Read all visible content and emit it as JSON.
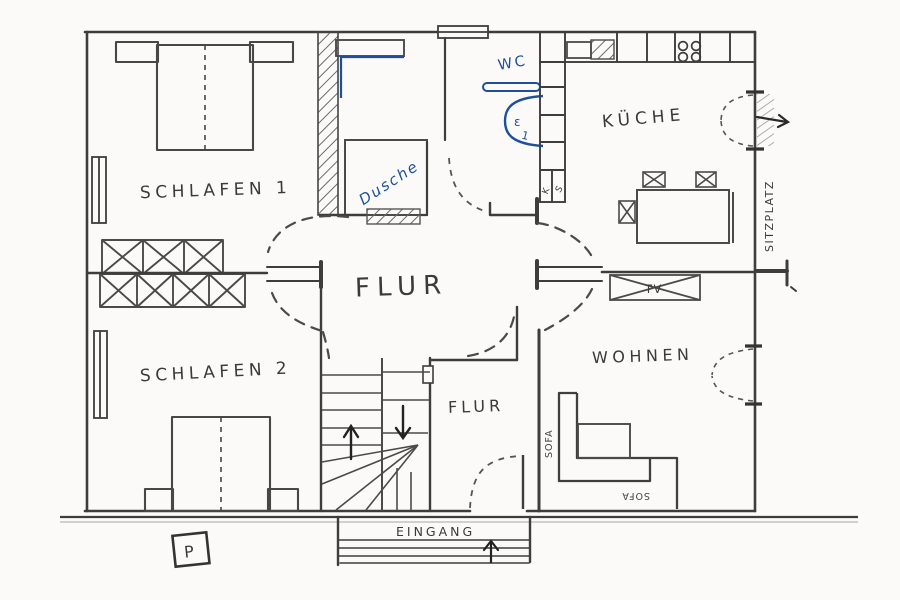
{
  "plan": {
    "rooms": {
      "schlafen1": {
        "label": "SCHLAFEN 1"
      },
      "schlafen2": {
        "label": "SCHLAFEN 2"
      },
      "flur_center": {
        "label": "FLUR"
      },
      "flur_lower": {
        "label": "FLUR"
      },
      "kueche": {
        "label": "KÜCHE"
      },
      "wohnen": {
        "label": "WOHNEN"
      },
      "bad": {
        "dusche_label": "Dusche",
        "wc_label": "WC",
        "toilet_marks": [
          "ε",
          "1"
        ]
      }
    },
    "outdoor": {
      "sitzplatz_label": "SITZPLATZ",
      "eingang_label": "EINGANG",
      "parking_label": "P"
    },
    "furniture": {
      "sofa_side_label": "SOFA",
      "sofa_bottom_label": "SOFA",
      "tv_label": "TV",
      "kitchen_cabinet_letters": [
        "K",
        "S"
      ]
    },
    "colors": {
      "paper": "#fbfaf8",
      "pencil": "#3d3d3d",
      "ink_blue": "#1d4f9c"
    }
  }
}
